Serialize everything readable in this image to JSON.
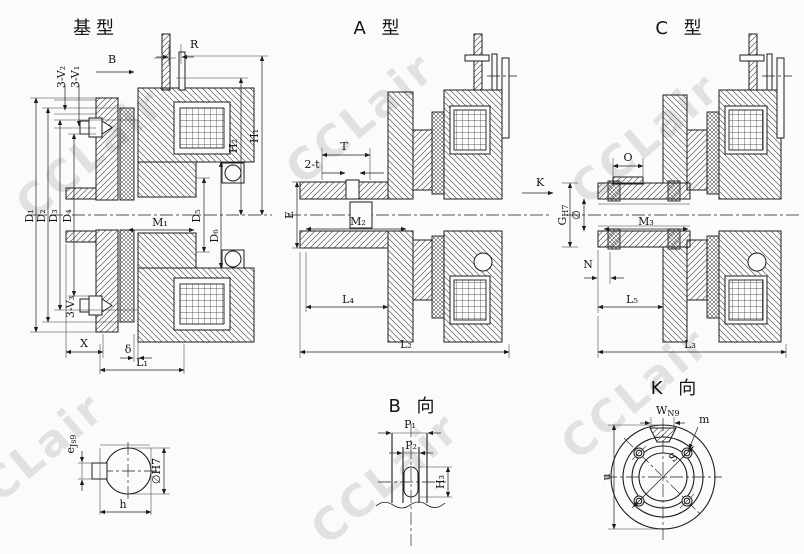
{
  "page": {
    "background": "#fbfbfa",
    "ink": "#1d1d1d",
    "watermark_text": "CCLair",
    "watermark_color": "#c9c9c9"
  },
  "views": {
    "base": {
      "title": "基型",
      "labels": {
        "b": "B",
        "r": "R",
        "v2": "3-V₂",
        "v1": "3-V₁",
        "h2": "H₂",
        "h1": "H₁",
        "d1": "D₁",
        "d2": "D₂",
        "d3": "D₃",
        "d4": "D₄",
        "d5": "D₅",
        "d6": "D₆",
        "m1": "M₁",
        "v3": "3-V₃",
        "x": "X",
        "delta": "δ",
        "l1": "L₁"
      }
    },
    "a_type": {
      "title": "A 型",
      "labels": {
        "t": "T",
        "two_t": "2-t",
        "e": "E",
        "m2": "M₂",
        "l4": "L₄",
        "l2": "L₂",
        "k": "K"
      }
    },
    "c_type": {
      "title": "C 型",
      "labels": {
        "o": "O",
        "g": "G",
        "g_sub": "H7",
        "dia": "∅",
        "m3": "M₃",
        "n": "N",
        "l5": "L₅",
        "l3": "L₃"
      }
    },
    "b_view": {
      "title": "B 向",
      "labels": {
        "p1": "P₁",
        "p2": "P₂",
        "h3": "H₃"
      }
    },
    "k_view": {
      "title": "K 向",
      "labels": {
        "w": "W",
        "w_sub": "N9",
        "m": "m",
        "s": "S",
        "u": "u"
      }
    },
    "bore_view": {
      "labels": {
        "e": "e",
        "e_sub": "Js9",
        "dia": "∅H7",
        "h": "h"
      }
    }
  }
}
